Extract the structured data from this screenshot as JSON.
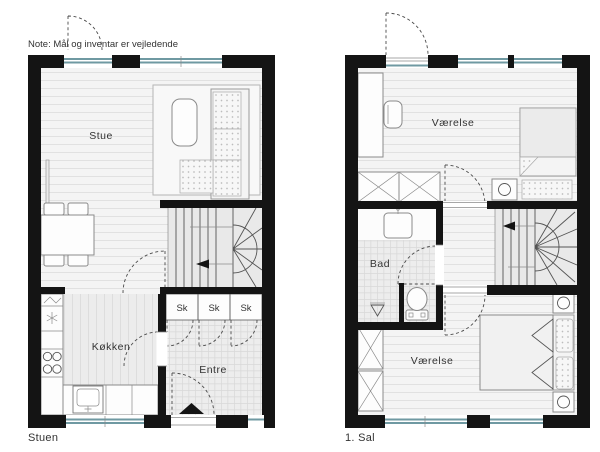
{
  "note": "Note: Mål og inventar er vejledende",
  "colors": {
    "wall": "#141414",
    "window": "#6f99a2",
    "ink": "#333333",
    "stroke": "#8a8a8a",
    "stair": "#e9e9e9"
  },
  "plans": [
    {
      "caption": "Stuen",
      "rooms": {
        "living": "Stue",
        "kitchen": "Køkken",
        "entry": "Entre",
        "closets": [
          "Sk",
          "Sk",
          "Sk"
        ]
      }
    },
    {
      "caption": "1. Sal",
      "rooms": {
        "bedroom_top": "Værelse",
        "bathroom": "Bad",
        "bedroom_bottom": "Værelse"
      }
    }
  ]
}
